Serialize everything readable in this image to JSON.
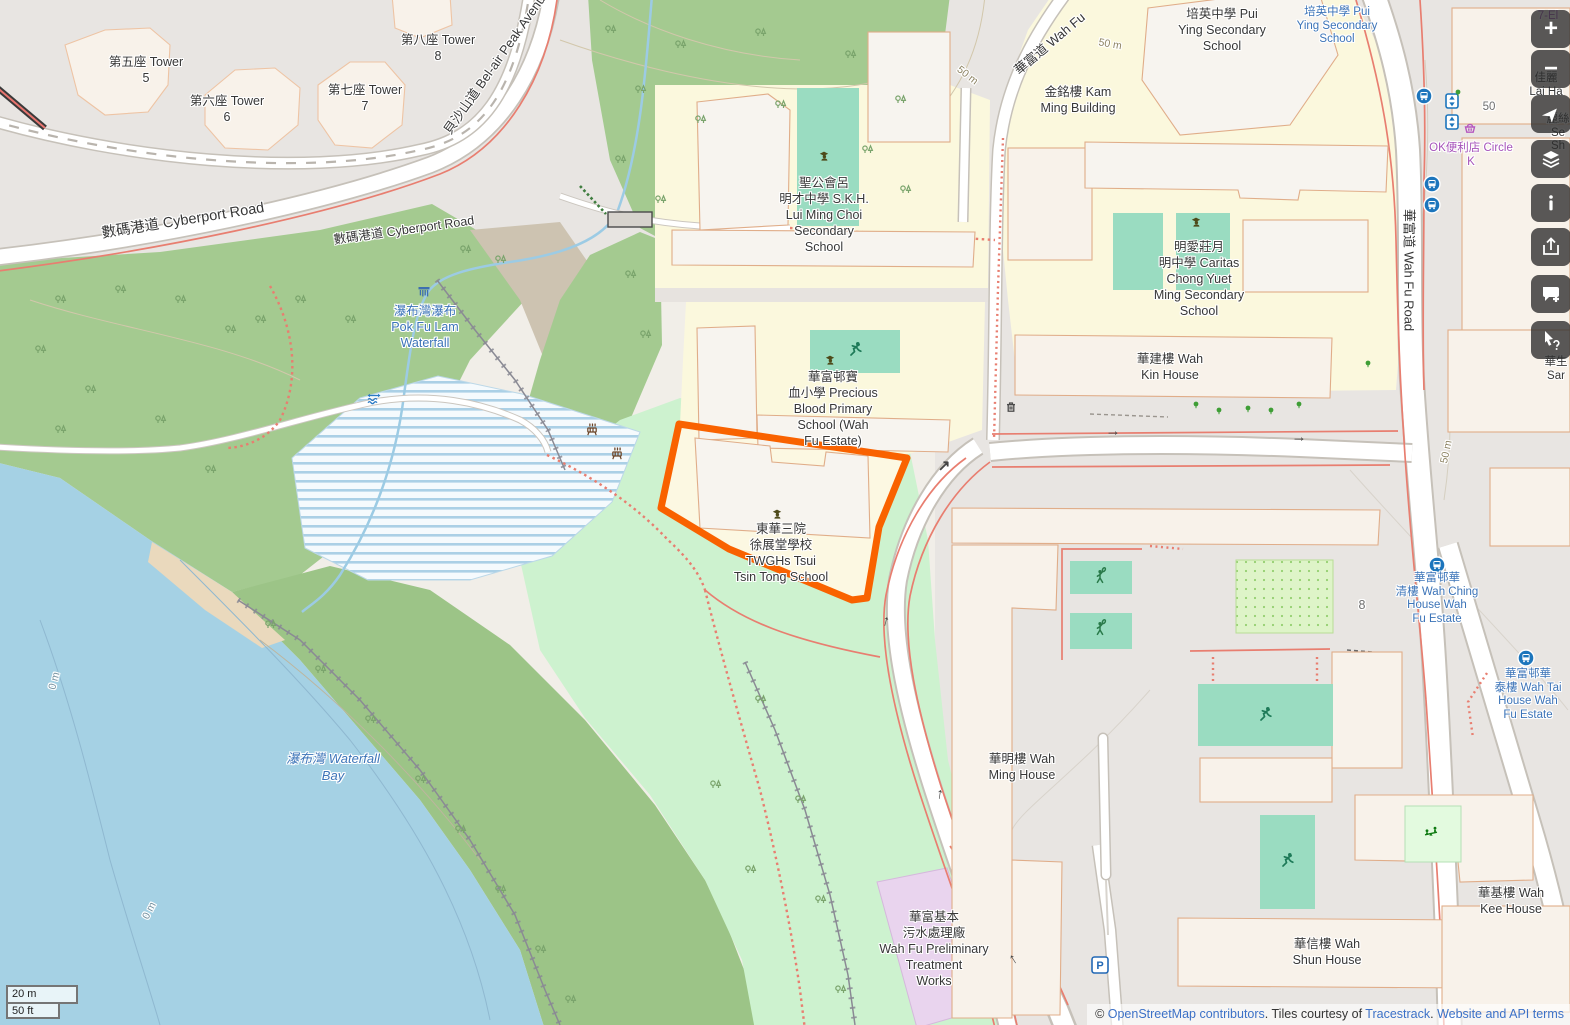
{
  "colors": {
    "highlight_outline": "#f96200",
    "water": "#a5d1e4",
    "forest": "#a4ca90",
    "park": "#cdf2cf",
    "school_area": "#fbf8dd",
    "pitch": "#9adcc1",
    "industrial": "#e9d4ee",
    "link_blue": "#3c71c7",
    "poi_blue": "#3c74b8",
    "shop_purple": "#a653ba"
  },
  "glyphs": {
    "zoom_in": "+",
    "zoom_out": "−",
    "oneway_right": "→",
    "oneway_up": "↑",
    "oneway_ne": "↗",
    "parking": "P"
  },
  "labels": {
    "tower5": {
      "lines": [
        "第五座 Tower",
        "5"
      ]
    },
    "tower6": {
      "lines": [
        "第六座 Tower",
        "6"
      ]
    },
    "tower7": {
      "lines": [
        "第七座 Tower",
        "7"
      ]
    },
    "tower8": {
      "lines": [
        "第八座 Tower",
        "8"
      ]
    },
    "belair": {
      "lines": [
        "貝沙山道 Bel-air Peak Avenue"
      ]
    },
    "cyberport1": {
      "lines": [
        "數碼港道 Cyberport Road"
      ]
    },
    "cyberport2": {
      "lines": [
        "數碼港道 Cyberport Road"
      ]
    },
    "wahfu_diag": {
      "lines": [
        "華富道 Wah Fu"
      ]
    },
    "wahfu_vert": {
      "lines": [
        "華富道 Wah Fu Road"
      ]
    },
    "puiying": {
      "lines": [
        "培英中學 Pui",
        "Ying Secondary",
        "School"
      ]
    },
    "puiying_blue": {
      "lines": [
        "培英中學 Pui",
        "Ying Secondary",
        "School"
      ]
    },
    "kamming": {
      "lines": [
        "金銘樓 Kam",
        "Ming Building"
      ]
    },
    "skh": {
      "lines": [
        "聖公會呂",
        "明才中學 S.K.H.",
        "Lui Ming Choi",
        "Secondary",
        "School"
      ]
    },
    "caritas": {
      "lines": [
        "明愛莊月",
        "明中學 Caritas",
        "Chong Yuet",
        "Ming Secondary",
        "School"
      ]
    },
    "precious": {
      "lines": [
        "華富邨寶",
        "血小學 Precious",
        "Blood Primary",
        "School (Wah",
        "Fu Estate)"
      ]
    },
    "twghs": {
      "lines": [
        "東華三院",
        "徐展堂學校",
        "TWGHs Tsui",
        "Tsin Tong School"
      ]
    },
    "wahkin": {
      "lines": [
        "華建樓 Wah",
        "Kin House"
      ]
    },
    "wahming": {
      "lines": [
        "華明樓 Wah",
        "Ming House"
      ]
    },
    "wahkee": {
      "lines": [
        "華基樓 Wah",
        "Kee House"
      ]
    },
    "wahshun": {
      "lines": [
        "華信樓 Wah",
        "Shun House"
      ]
    },
    "waterfall": {
      "lines": [
        "瀑布灣瀑布",
        "Pok Fu Lam",
        "Waterfall"
      ]
    },
    "bay": {
      "lines": [
        "瀑布灣 Waterfall",
        "Bay"
      ]
    },
    "treatment": {
      "lines": [
        "華富基本",
        "污水處理廠",
        "Wah Fu Preliminary",
        "Treatment",
        "Works"
      ]
    },
    "circlek": {
      "lines": [
        "OK便利店 Circle",
        "K"
      ]
    },
    "wahching": {
      "lines": [
        "華富邨華",
        "清樓 Wah Ching",
        "House Wah",
        "Fu Estate"
      ]
    },
    "wahtai": {
      "lines": [
        "華富邨華",
        "泰樓 Wah Tai",
        "House Wah",
        "Fu Estate"
      ]
    },
    "seveneleven": {
      "lines": [
        "7-El"
      ]
    },
    "laiha": {
      "lines": [
        "佳麗",
        "Lai Ha"
      ]
    },
    "laisze": {
      "lines": [
        "麗絲",
        "Se",
        "Sh"
      ]
    },
    "wahsang": {
      "lines": [
        "華生",
        "Sar"
      ]
    },
    "num8": {
      "lines": [
        "8"
      ]
    },
    "num50": {
      "lines": [
        "50"
      ]
    },
    "c50a": {
      "lines": [
        "50 m"
      ]
    },
    "c50b": {
      "lines": [
        "50 m"
      ]
    },
    "c50c": {
      "lines": [
        "50 m"
      ]
    },
    "c0a": {
      "lines": [
        "0 m"
      ]
    },
    "c0b": {
      "lines": [
        "0 m"
      ]
    }
  },
  "scalebar": {
    "metric": "20 m",
    "imperial": "50 ft"
  },
  "attribution": {
    "prefix": "© ",
    "osm_link": "OpenStreetMap contributors",
    "tiles_text": ". Tiles courtesy of ",
    "tracestrack_link": "Tracestrack",
    "sep": ". ",
    "terms_link": "Website and API terms"
  }
}
